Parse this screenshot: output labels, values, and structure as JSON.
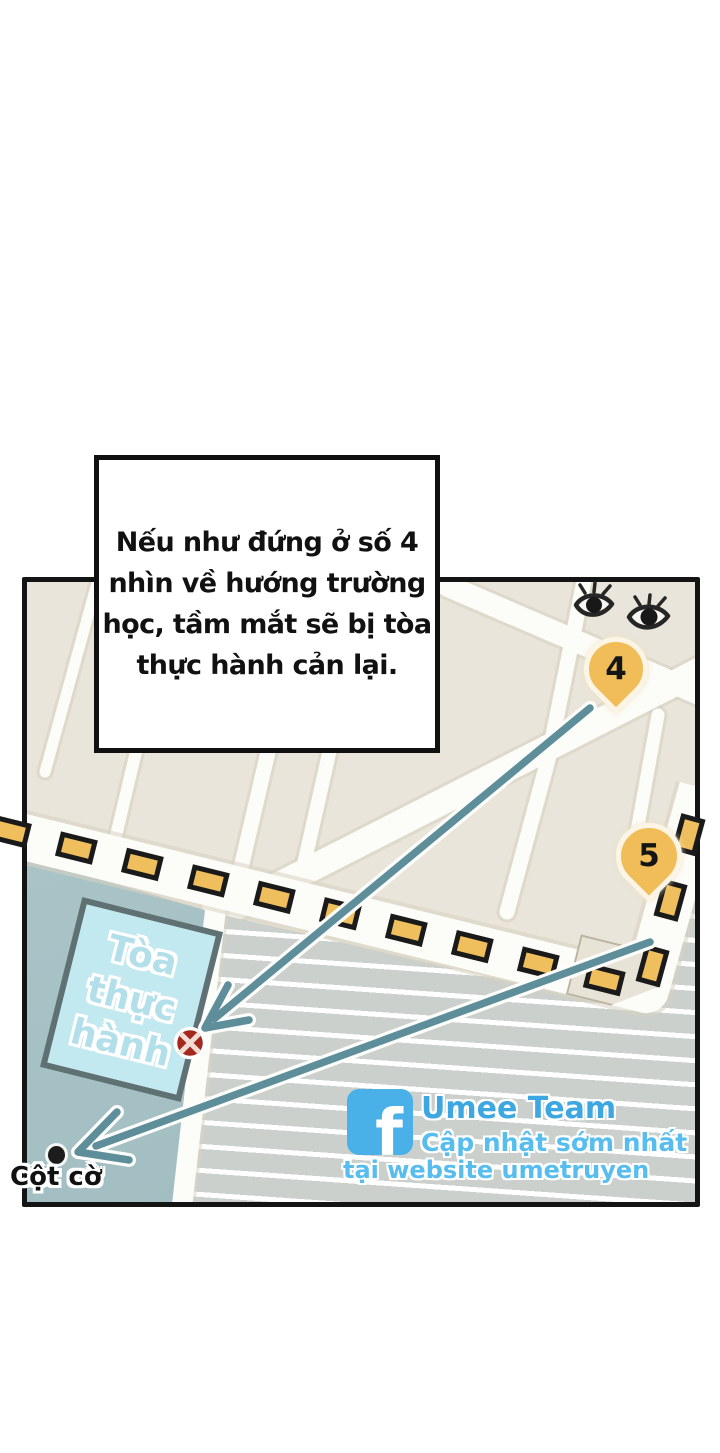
{
  "callout": {
    "lines": [
      "Nếu như đứng ở số 4",
      "nhìn về hướng trường",
      "học, tầm mắt sẽ bị tòa",
      "thực hành cản lại."
    ]
  },
  "map": {
    "pins": [
      {
        "label": "4"
      },
      {
        "label": "5"
      }
    ],
    "building": {
      "name": "Tòa thực hành",
      "lines": [
        "Tòa",
        "thực",
        "hành"
      ]
    },
    "flagpole": {
      "label": "Cột cờ"
    },
    "icons": {
      "eyes": "watching-eyes",
      "blocked_marker": "crossed-circle",
      "route": "dashed-route"
    },
    "colors": {
      "dash_yellow": "#f0bf5d",
      "arrow_teal": "#5e8e9a",
      "campus_teal": "#a7c2c6",
      "building_fill": "#c2e9ef",
      "building_border": "#5f7173",
      "stripe_gray": "#cbd0cc",
      "pin_yellow": "#f0bd58",
      "marker_red": "#a3281e",
      "block_beige": "#e9e5da"
    }
  },
  "watermark": {
    "fb_letter": "f",
    "brand": "Umee Team",
    "tagline1": "Cập nhật sớm nhất",
    "tagline2": "tại website umetruyen",
    "brand_color": "#3da7e1",
    "fb_blue": "#49b0e8"
  }
}
